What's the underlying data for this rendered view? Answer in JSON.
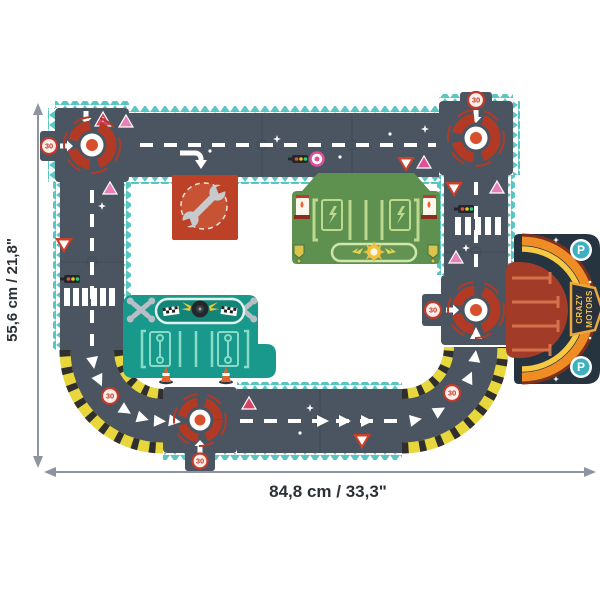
{
  "dimension_annotations": {
    "height_label": "55,6 cm / 21,8\"",
    "width_label": "84,8 cm / 33,3\""
  },
  "road_signs": {
    "speed_limit": "30",
    "warning_exclamation": "!"
  },
  "garage": {
    "brand_line1": "CRAZY",
    "brand_line2": "MOTORS",
    "parking_letter": "P"
  },
  "colors": {
    "road": "#4a5561",
    "edge_teal": "#5bc6c1",
    "hazard_yellow": "#e8d73c",
    "hazard_black": "#2f2f2f",
    "target_red": "#b23a25",
    "target_dot": "#d84f2e",
    "mat_green": "#5e9150",
    "mat_green_lines": "#bcd98e",
    "mat_teal": "#18998c",
    "mat_teal_lines": "#86dbc9",
    "repair_tile_red": "#bc4126",
    "garage_navy": "#263440",
    "garage_red": "#a23b28",
    "arc_orange": "#ef8c24",
    "arc_yellow": "#f7c943",
    "pink_sign": "#e0509a",
    "dimension_gray": "#8e95a1"
  },
  "icons": [
    "roundabout-target-icon",
    "speed-sign-30-icon",
    "warning-triangle-icon",
    "yield-triangle-icon",
    "traffic-light-icon",
    "pedestrian-crossing-icon",
    "direction-arrow-icon",
    "chevron-arrow-icon",
    "wrench-icon",
    "crossed-wrenches-icon",
    "gas-pump-icon",
    "lightning-bolt-icon",
    "sun-emblem-icon",
    "shield-badge-icon",
    "checkered-flag-icon",
    "winged-tire-icon",
    "traffic-cone-icon",
    "parking-sign-icon",
    "hazard-stripe-icon",
    "sparkle-icon"
  ]
}
